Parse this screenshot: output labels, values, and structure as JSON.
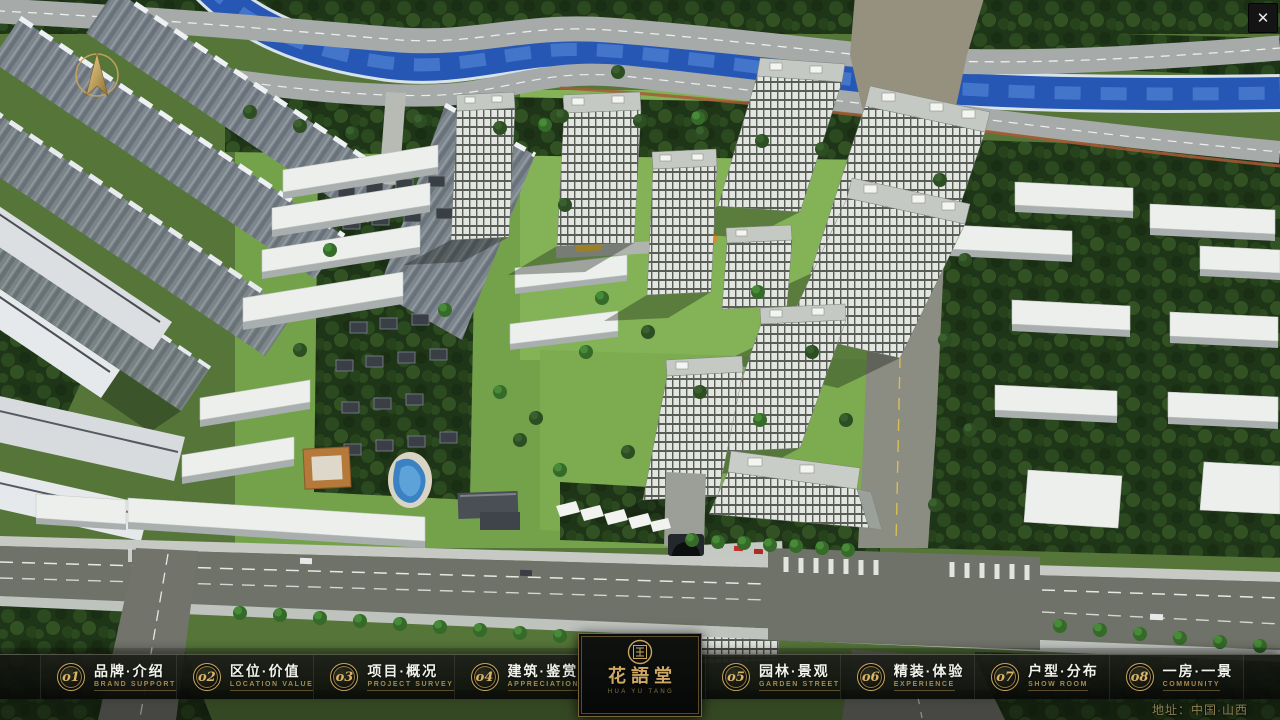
{
  "chrome": {
    "close_glyph": "✕"
  },
  "icons": {
    "close": "close-icon",
    "compass": "compass-north-arrow",
    "seal": "round-seal-emblem"
  },
  "nav": {
    "items": [
      {
        "num": "o1",
        "title": "品牌·介绍",
        "subtitle": "BRAND SUPPORT"
      },
      {
        "num": "o2",
        "title": "区位·价值",
        "subtitle": "LOCATION VALUE"
      },
      {
        "num": "o3",
        "title": "项目·概况",
        "subtitle": "PROJECT SURVEY"
      },
      {
        "num": "o4",
        "title": "建筑·鉴赏",
        "subtitle": "APPRECIATION"
      },
      {
        "num": "o5",
        "title": "园林·景观",
        "subtitle": "GARDEN STREET"
      },
      {
        "num": "o6",
        "title": "精装·体验",
        "subtitle": "EXPERIENCE"
      },
      {
        "num": "o7",
        "title": "户型·分布",
        "subtitle": "SHOW ROOM"
      },
      {
        "num": "o8",
        "title": "一房·一景",
        "subtitle": "COMMUNITY"
      }
    ]
  },
  "logo": {
    "title": "花語堂",
    "caption": "HUA YU TANG"
  },
  "footer": {
    "address": "地址：中国·山西"
  },
  "colors": {
    "gold": "#c9a55e",
    "gold_dim": "#a8894f",
    "nav_bg": "rgba(10,12,9,0.9)",
    "river": "#2757b4",
    "title_text": "#f2f2ec"
  }
}
